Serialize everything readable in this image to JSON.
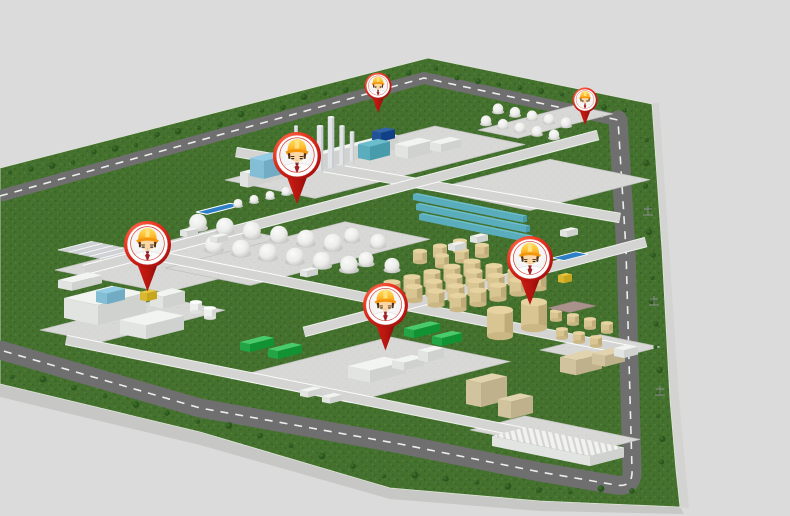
{
  "scene": {
    "kind": "3d-industrial-park-map",
    "icons": {
      "marker": "map-pin-icon",
      "marker_content": "worker-avatar-icon"
    },
    "markers": [
      {
        "id": "worker-1",
        "x": 378,
        "y": 113,
        "size": 27
      },
      {
        "id": "worker-2",
        "x": 585,
        "y": 125,
        "size": 25
      },
      {
        "id": "worker-3",
        "x": 297,
        "y": 204,
        "size": 48
      },
      {
        "id": "worker-4",
        "x": 147,
        "y": 291,
        "size": 47
      },
      {
        "id": "worker-5",
        "x": 385,
        "y": 350,
        "size": 45
      },
      {
        "id": "worker-6",
        "x": 530,
        "y": 305,
        "size": 46
      }
    ]
  },
  "palette": {
    "background": "#dbdbdb",
    "slab_bottom": "#c7c7c5",
    "slab_right": "#d3d3d1",
    "grass": "#44722e",
    "grass_dot_dark": "#315723",
    "grass_dot_light": "#5c8d3d",
    "tree": "#2c5520",
    "tree_light": "#3d7029",
    "road": "#6f6f6f",
    "road_dash": "#ededed",
    "internal_road": "#d4d4d2",
    "internal_road_edge": "#ffffff",
    "pad": "#d8d9d6",
    "pad_edge": "#c0c1be",
    "pad_texture": "#c6c7c4",
    "building_white": "#eef0ee",
    "equipment_blue": "#8fc9e2",
    "equipment_teal": "#66b9c9",
    "equipment_navy": "#2e5fa5",
    "column_gray": "#e2e5e7",
    "tank_beige": "#d9c592",
    "building_tan": "#dccfa9",
    "rack_green": "#2fb151",
    "pool_blue": "#2e7fc6",
    "accent_yellow": "#e5c33c",
    "pad_mauve": "#a9928b",
    "pin_red": "#ee3a22",
    "pin_red_dark": "#8e0d0b",
    "pin_ring": "#ffffff",
    "helmet_yellow": "#ffdf66",
    "helmet_orange": "#fca114",
    "helmet_brim": "#f5950a",
    "skin": "#fbd7a6",
    "hair": "#533018",
    "tie": "#9e2227",
    "shirt": "#fcfcfc"
  }
}
